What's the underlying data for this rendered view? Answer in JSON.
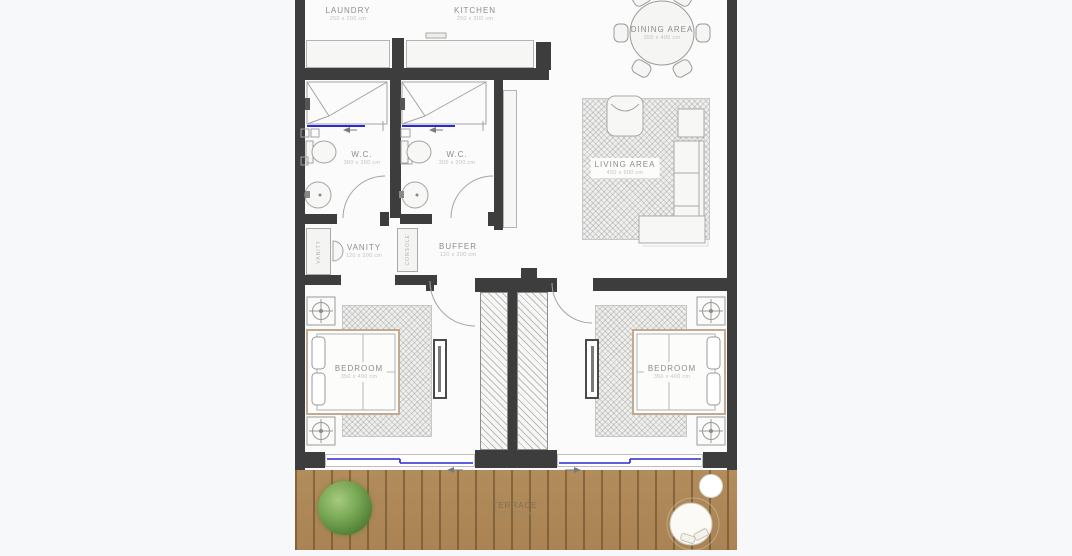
{
  "page": {
    "background": "#f7f8fa"
  },
  "rooms": {
    "laundry": {
      "name": "LAUNDRY",
      "dims": "250 x 200 cm"
    },
    "kitchen": {
      "name": "KITCHEN",
      "dims": "250 x 300 cm"
    },
    "dining": {
      "name": "DINING AREA",
      "dims": "350 x 400 cm"
    },
    "wc_left": {
      "name": "W.C.",
      "dims": "300 x 200 cm"
    },
    "wc_right": {
      "name": "W.C.",
      "dims": "300 x 200 cm"
    },
    "living": {
      "name": "LIVING AREA",
      "dims": "450 x 500 cm"
    },
    "vanity": {
      "name": "VANITY",
      "dims": "120 x 200 cm"
    },
    "buffer": {
      "name": "BUFFER",
      "dims": "120 x 200 cm"
    },
    "bedroom_left": {
      "name": "BEDROOM",
      "dims": "350 x 400 cm"
    },
    "bedroom_right": {
      "name": "BEDROOM",
      "dims": "350 x 400 cm"
    },
    "terrace": {
      "name": "TERRACE",
      "dims": "150 x 900 cm"
    }
  },
  "cabinets": {
    "vanity": "VANITY",
    "console": "CONSOLE"
  },
  "colors": {
    "wall": "#3d3d3d",
    "floor": "#fbfbfc",
    "terrace_wood": "#b28c5b",
    "window_glass": "#2a2ad0",
    "tree_green": "#6fa04e",
    "furniture_line": "#a3a3a3",
    "label_text": "#8c8c8c",
    "dims_text": "#c2c2c2"
  }
}
